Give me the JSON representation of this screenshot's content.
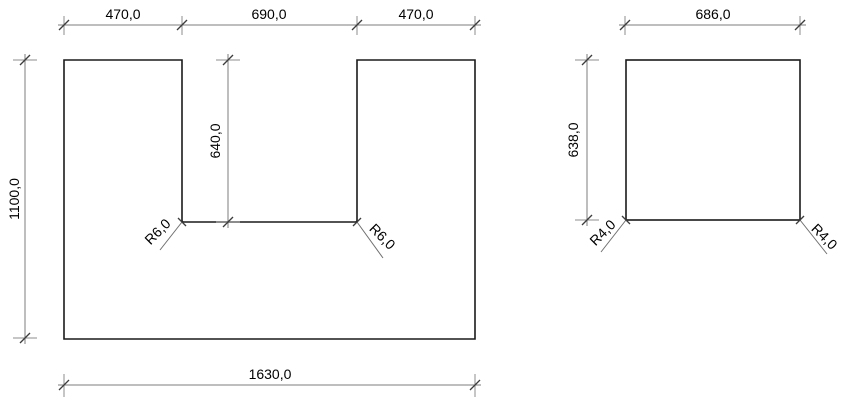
{
  "colors": {
    "background": "#ffffff",
    "outline": "#1a1a1a",
    "dimension_lines": "#7d7d7d",
    "label_text": "#000000"
  },
  "left_part": {
    "dim_top_left_segment": "470,0",
    "dim_top_middle_segment": "690,0",
    "dim_top_right_segment": "470,0",
    "dim_overall_height": "1100,0",
    "dim_notch_depth": "640,0",
    "dim_notch_radius_left": "R6,0",
    "dim_notch_radius_right": "R6,0",
    "dim_overall_width": "1630,0"
  },
  "right_part": {
    "dim_width": "686,0",
    "dim_height": "638,0",
    "dim_corner_radius_left": "R4,0",
    "dim_corner_radius_right": "R4,0"
  }
}
